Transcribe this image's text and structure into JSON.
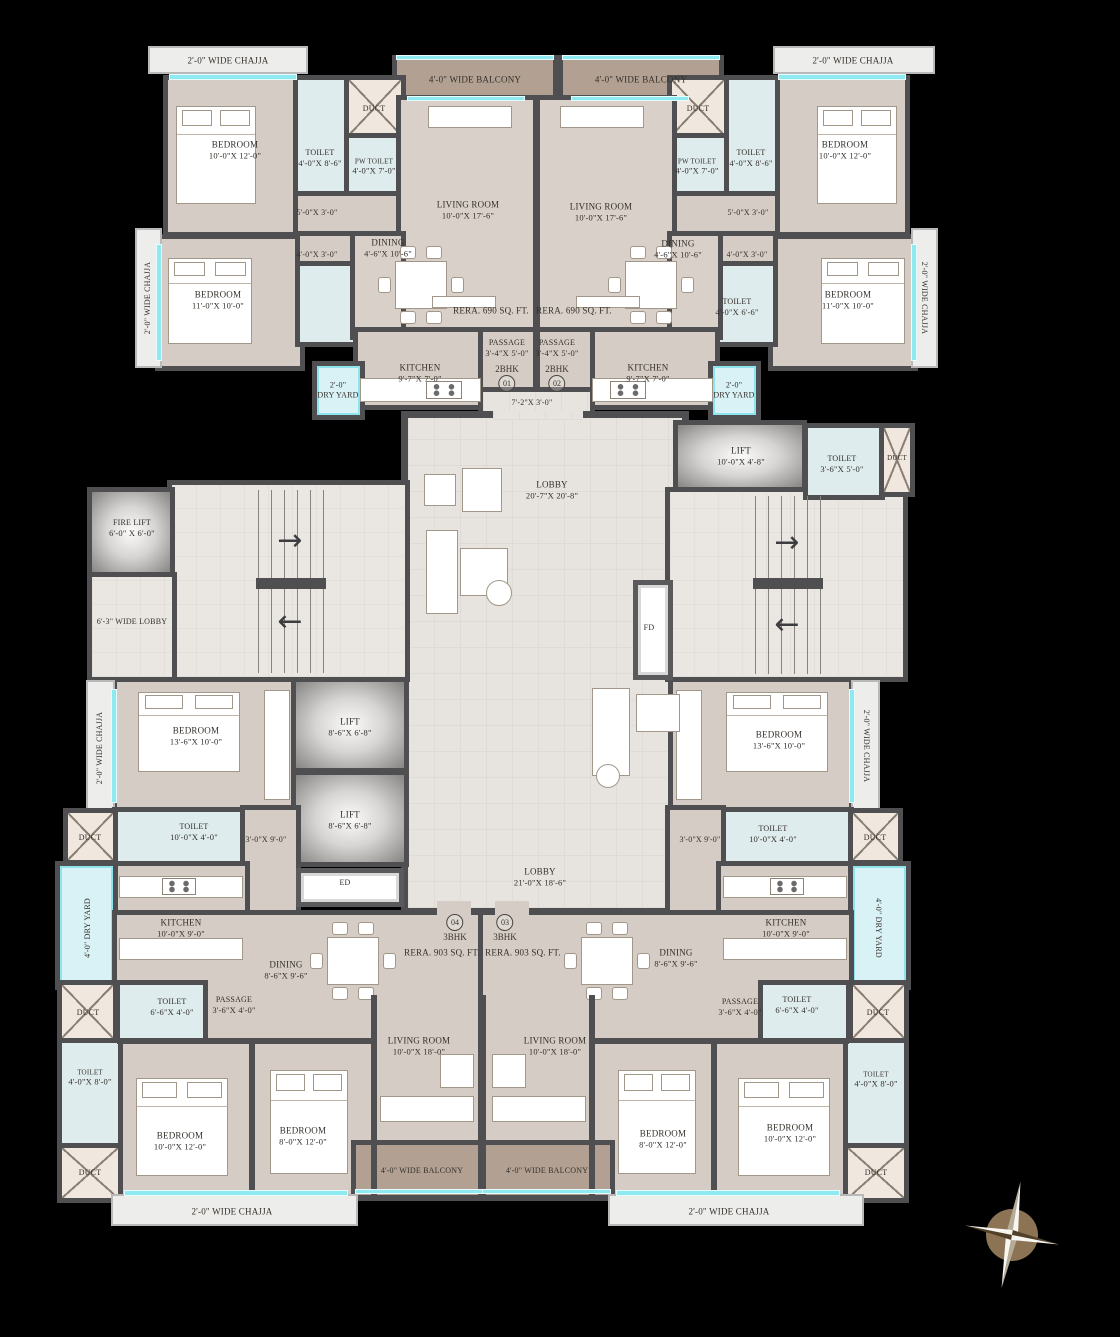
{
  "common": {
    "duct": "DUCT",
    "fd": "FD",
    "ed": "ED",
    "chajja_2": "2'-0\" WIDE CHAJJA",
    "balcony_4": "4'-0\" WIDE BALCONY",
    "dryyard_2a": "2'-0\"",
    "dryyard_2b": "DRY YARD",
    "dryyard_4": "4'-0\" DRY YARD",
    "rera_690": "RERA. 690 SQ. FT.",
    "rera_903": "RERA. 903 SQ. FT."
  },
  "units": {
    "u01": {
      "type": "2BHK",
      "num": "01"
    },
    "u02": {
      "type": "2BHK",
      "num": "02"
    },
    "u03": {
      "type": "3BHK",
      "num": "03"
    },
    "u04": {
      "type": "3BHK",
      "num": "04"
    }
  },
  "rooms": {
    "bedroom_10x12": {
      "n": "BEDROOM",
      "d": "10'-0\"X 12'-0\""
    },
    "bedroom_11x10": {
      "n": "BEDROOM",
      "d": "11'-0\"X 10'-0\""
    },
    "bedroom_13x10": {
      "n": "BEDROOM",
      "d": "13'-6\"X 10'-0\""
    },
    "bedroom_8x12": {
      "n": "BEDROOM",
      "d": "8'-0\"X 12'-0\""
    },
    "living_10x17": {
      "n": "LIVING ROOM",
      "d": "10'-0\"X 17'-6\""
    },
    "living_10x18": {
      "n": "LIVING ROOM",
      "d": "10'-0\"X 18'-0\""
    },
    "dining_4x10": {
      "n": "DINING",
      "d": "4'-6\"X 10'-6\""
    },
    "dining_8x9": {
      "n": "DINING",
      "d": "8'-6\"X 9'-6\""
    },
    "kitchen_9x7": {
      "n": "KITCHEN",
      "d": "9'-7\"X 7'-0\""
    },
    "kitchen_10x9": {
      "n": "KITCHEN",
      "d": "10'-0\"X 9'-0\""
    },
    "toilet_4x8_6": {
      "n": "TOILET",
      "d": "4'-0\"X 8'-6\""
    },
    "toilet_4x6_6": {
      "n": "TOILET",
      "d": "4'-0\"X 6'-6\""
    },
    "toilet_3x5": {
      "n": "TOILET",
      "d": "3'-6\"X 5'-0\""
    },
    "toilet_10x4": {
      "n": "TOILET",
      "d": "10'-0\"X 4'-0\""
    },
    "toilet_6x4": {
      "n": "TOILET",
      "d": "6'-6\"X 4'-0\""
    },
    "toilet_4x8": {
      "n": "TOILET",
      "d": "4'-0\"X 8'-0\""
    },
    "pw_toilet": {
      "n": "PW TOILET",
      "d": "4'-0\"X 7'-0\""
    },
    "passage_3_4x5": {
      "n": "PASSAGE",
      "d": "3'-4\"X 5'-0\""
    },
    "passage_3_6x4": {
      "n": "PASSAGE",
      "d": "3'-6\"X 4'-0\""
    },
    "lift_10x4": {
      "n": "LIFT",
      "d": "10'-0\"X 4'-8\""
    },
    "lift_8x6": {
      "n": "LIFT",
      "d": "8'-6\"X 6'-8\""
    },
    "fire_lift": {
      "n": "FIRE LIFT",
      "d": "6'-0\" X 6'-0\""
    },
    "lobby_20": {
      "n": "LOBBY",
      "d": "20'-7\"X 20'-8\""
    },
    "lobby_21": {
      "n": "LOBBY",
      "d": "21'-0\"X 18'-6\""
    },
    "wide_lobby": "6'-3\" WIDE LOBBY",
    "pass_5x3": "5'-0\"X 3'-0\"",
    "pass_4x3": "4'-0\"X 3'-0\"",
    "pass_3x9": "3'-0\"X 9'-0\"",
    "entry_7x3": "7'-2\"X 3'-0\""
  },
  "colors": {
    "wall": "#4f4f51",
    "floor": "#d5ccc5",
    "lobby_floor": "#e7e4e0",
    "toilet": "#dfecee",
    "balcony": "#b2a192",
    "dry_yard": "#d9f2f5",
    "window": "#8fe9f1",
    "compass": "#8c7354"
  }
}
